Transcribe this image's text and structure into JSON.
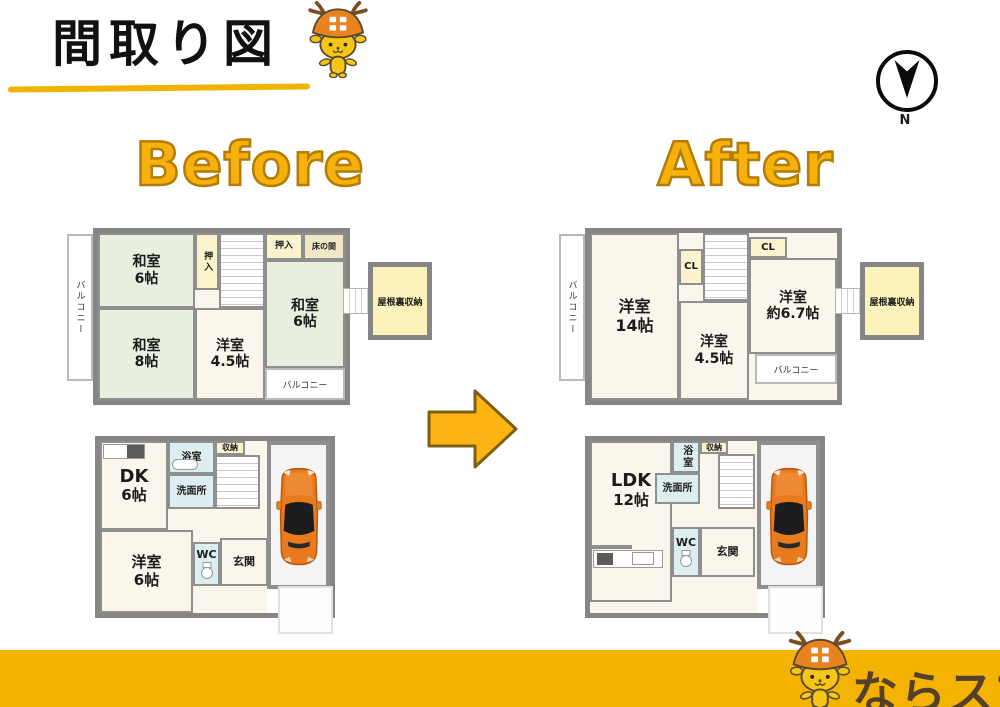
{
  "header": {
    "title": "間取り図",
    "compass_n": "N"
  },
  "sections": {
    "before": "Before",
    "after": "After"
  },
  "footer": {
    "brand": "ならスマ"
  },
  "colors": {
    "accent_yellow": "#F5B301",
    "headline_gold": "#F7B10C",
    "wall_gray": "#8A8A8A",
    "tatami_green": "#E9EFDF",
    "room_cream": "#FBF6EC",
    "closet_yellow": "#FAF3CD",
    "tokonoma_beige": "#F1E7C6",
    "wet_area_cyan": "#DDEEF0",
    "car_orange": "#E87A1F",
    "brand_brown": "#54402B"
  },
  "plans": {
    "before2f": {
      "balcony_left": "バルコニー",
      "balcony_right": "バルコニー",
      "attic": "屋根裏収納",
      "washitsu6a_name": "和室",
      "washitsu6a_size": "6帖",
      "washitsu8_name": "和室",
      "washitsu8_size": "8帖",
      "oshiire_left": "押入",
      "oshiire_top": "押入",
      "tokonoma": "床の間",
      "washitsu6b_name": "和室",
      "washitsu6b_size": "6帖",
      "yoshitsu45_name": "洋室",
      "yoshitsu45_size": "4.5帖"
    },
    "before1f": {
      "dk_name": "DK",
      "dk_size": "6帖",
      "bath": "浴室",
      "storage": "収納",
      "washroom": "洗面所",
      "yoshitsu6_name": "洋室",
      "yoshitsu6_size": "6帖",
      "wc": "WC",
      "genkan": "玄関"
    },
    "after2f": {
      "balcony_left": "バルコニー",
      "balcony_right": "バルコニー",
      "attic": "屋根裏収納",
      "yoshitsu14_name": "洋室",
      "yoshitsu14_size": "14帖",
      "cl1": "CL",
      "cl2": "CL",
      "yoshitsu67_name": "洋室",
      "yoshitsu67_size": "約6.7帖",
      "yoshitsu45_name": "洋室",
      "yoshitsu45_size": "4.5帖"
    },
    "after1f": {
      "ldk_name": "LDK",
      "ldk_size": "12帖",
      "bath": "浴室",
      "storage": "収納",
      "washroom": "洗面所",
      "wc": "WC",
      "genkan": "玄関"
    }
  }
}
